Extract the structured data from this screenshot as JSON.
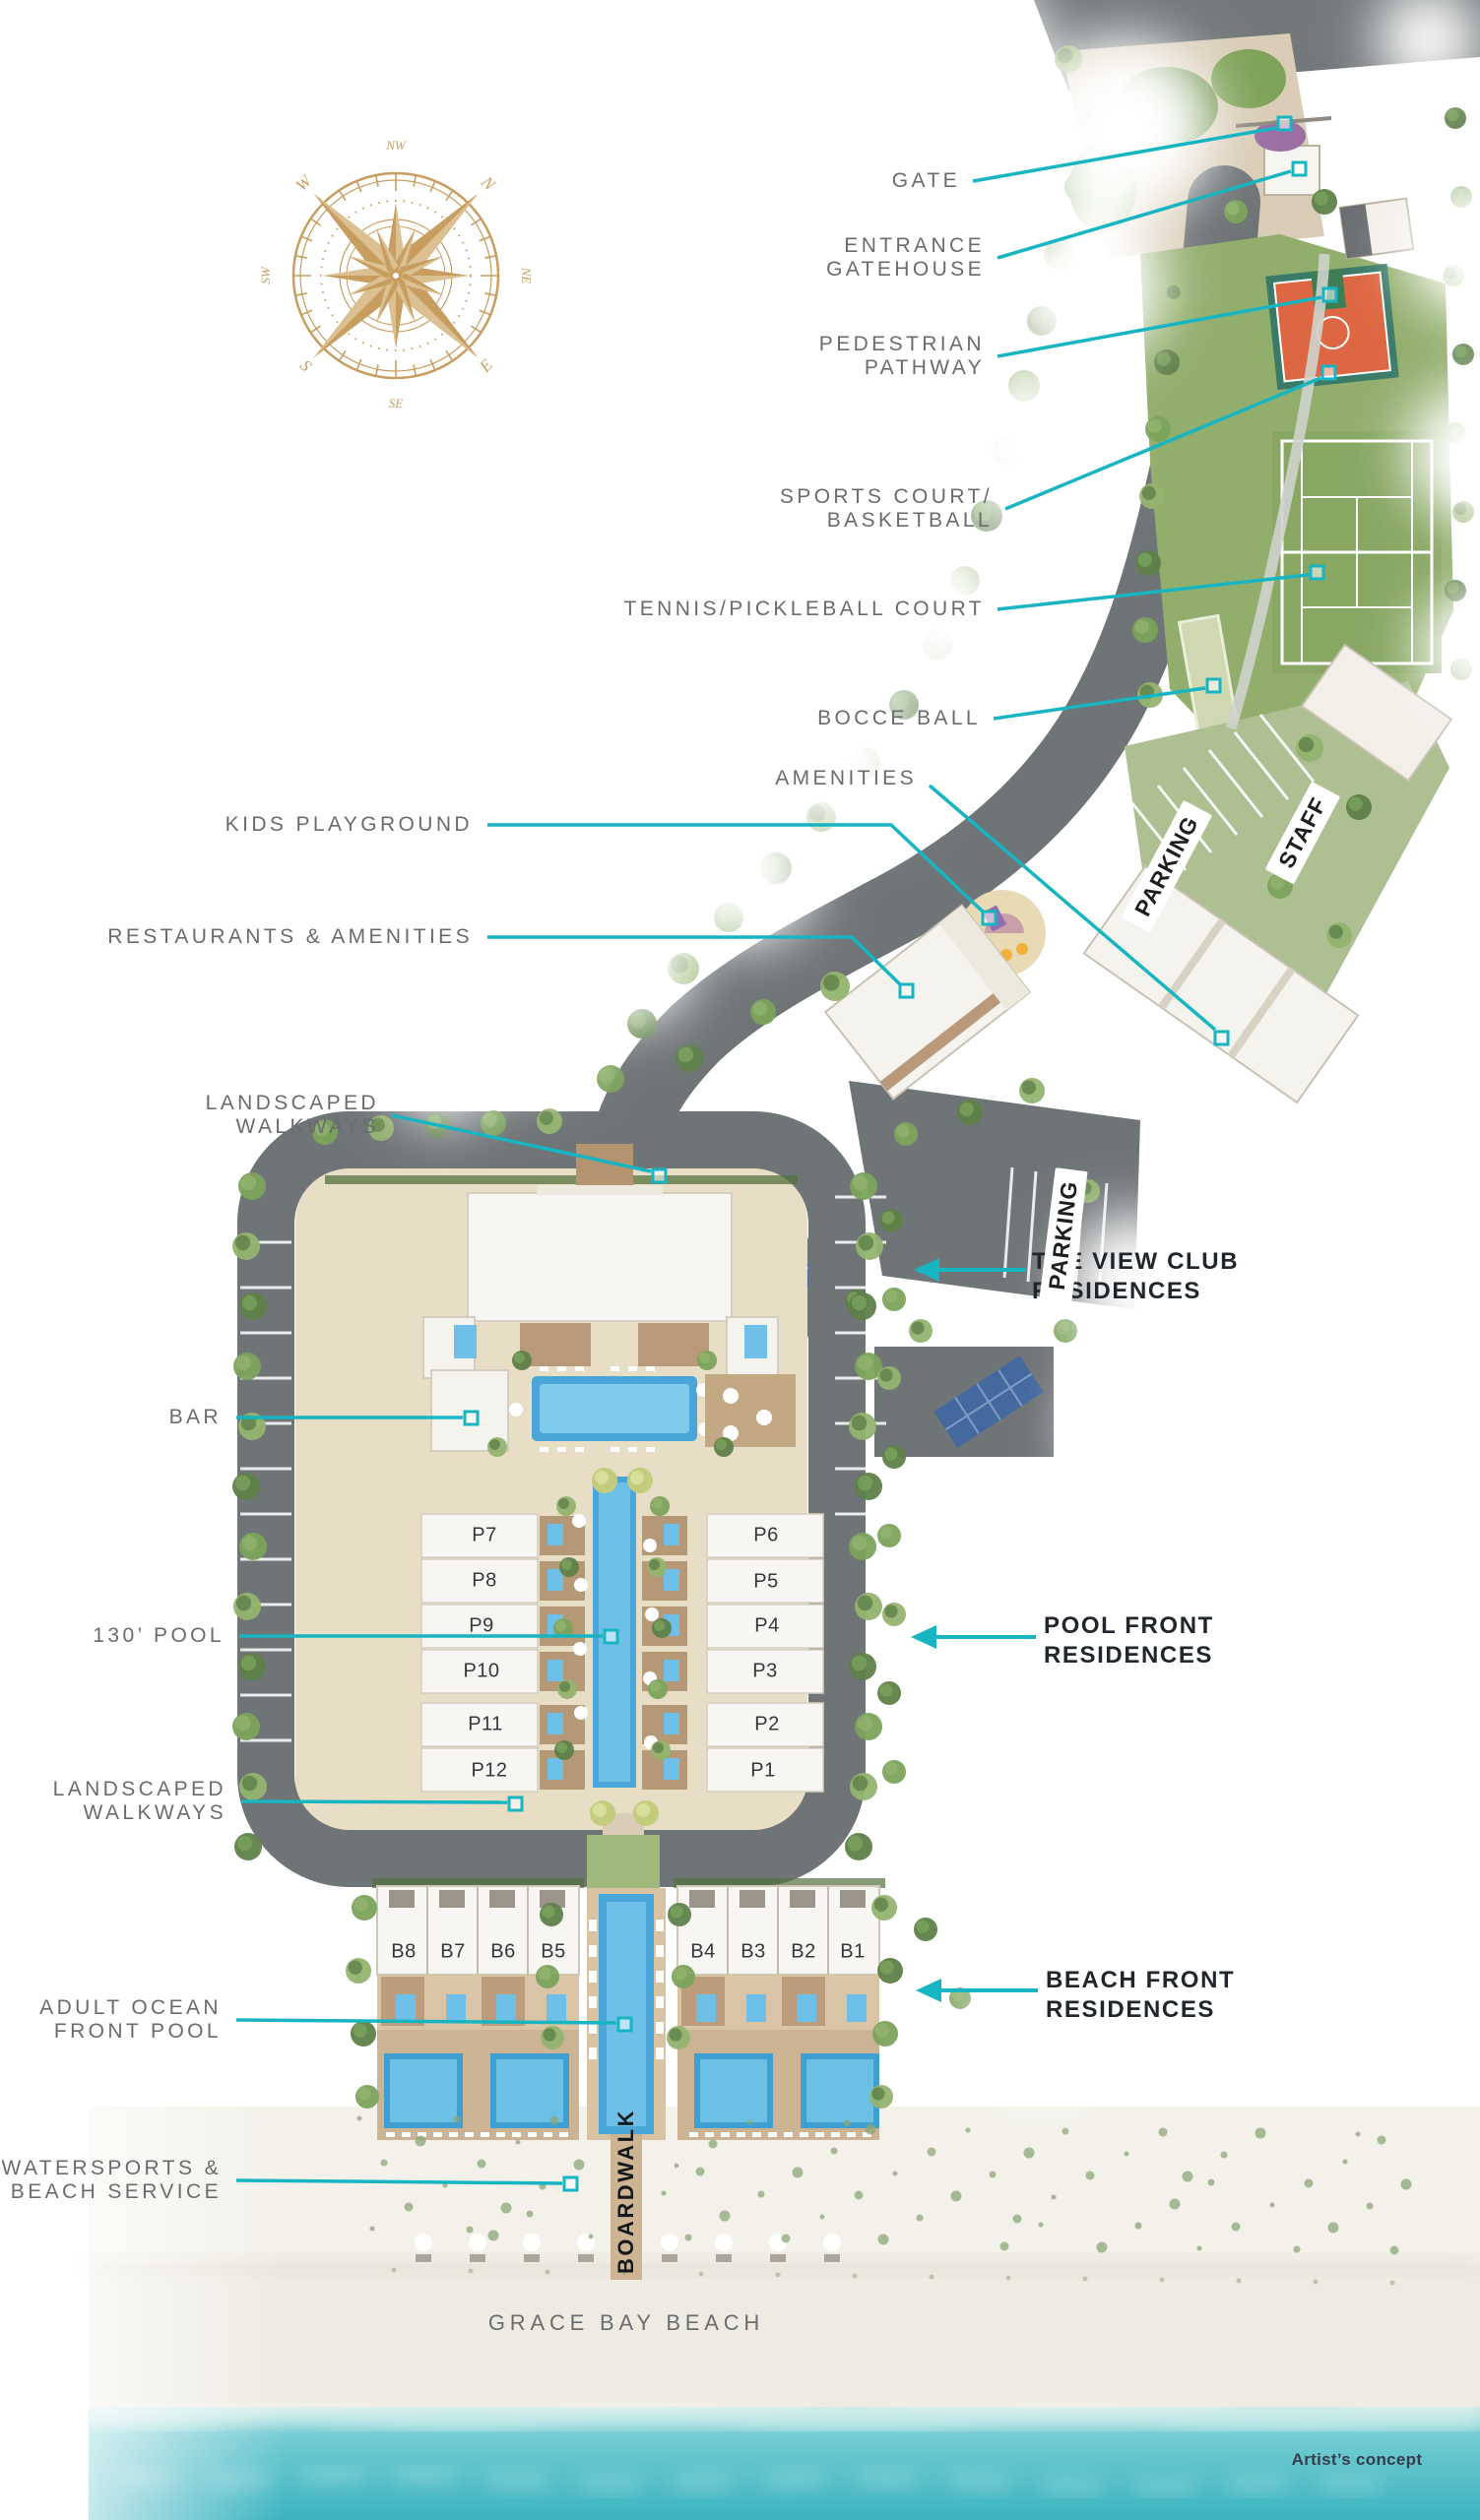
{
  "annotations": {
    "callouts": [
      {
        "id": "gate",
        "lines": [
          "GATE"
        ]
      },
      {
        "id": "entrance-gatehouse",
        "lines": [
          "ENTRANCE",
          "GATEHOUSE"
        ]
      },
      {
        "id": "pedestrian-pathway",
        "lines": [
          "PEDESTRIAN",
          "PATHWAY"
        ]
      },
      {
        "id": "sports-court-basketball",
        "lines": [
          "SPORTS COURT/",
          "BASKETBALL"
        ]
      },
      {
        "id": "tennis-pickleball-court",
        "lines": [
          "TENNIS/PICKLEBALL COURT"
        ]
      },
      {
        "id": "bocce-ball",
        "lines": [
          "BOCCE BALL"
        ]
      },
      {
        "id": "amenities",
        "lines": [
          "AMENITIES"
        ]
      },
      {
        "id": "kids-playground",
        "lines": [
          "KIDS PLAYGROUND"
        ]
      },
      {
        "id": "restaurants-amenities",
        "lines": [
          "RESTAURANTS & AMENITIES"
        ]
      },
      {
        "id": "landscaped-walkways-north",
        "lines": [
          "LANDSCAPED",
          "WALKWAYS"
        ]
      },
      {
        "id": "bar",
        "lines": [
          "BAR"
        ]
      },
      {
        "id": "pool-130",
        "lines": [
          "130’ POOL"
        ]
      },
      {
        "id": "landscaped-walkways-south",
        "lines": [
          "LANDSCAPED",
          "WALKWAYS"
        ]
      },
      {
        "id": "adult-ocean-front-pool",
        "lines": [
          "ADULT OCEAN",
          "FRONT POOL"
        ]
      },
      {
        "id": "watersports-beach-service",
        "lines": [
          "WATERSPORTS &",
          "BEACH SERVICE"
        ]
      }
    ],
    "residences": [
      {
        "id": "view-club-residences",
        "lines": [
          "THE VIEW CLUB",
          "RESIDENCES"
        ]
      },
      {
        "id": "pool-front-residences",
        "lines": [
          "POOL FRONT",
          "RESIDENCES"
        ]
      },
      {
        "id": "beach-front-residences",
        "lines": [
          "BEACH FRONT",
          "RESIDENCES"
        ]
      }
    ]
  },
  "map_labels": {
    "parking_upper": "PARKING",
    "staff": "STAFF",
    "parking_lower": "PARKING",
    "boardwalk": "BOARDWALK",
    "beach_name": "GRACE BAY BEACH"
  },
  "units": {
    "pool_front": [
      "P7",
      "P8",
      "P9",
      "P10",
      "P11",
      "P12",
      "P6",
      "P5",
      "P4",
      "P3",
      "P2",
      "P1"
    ],
    "beach_front": [
      "B8",
      "B7",
      "B6",
      "B5",
      "B4",
      "B3",
      "B2",
      "B1"
    ]
  },
  "compass": {
    "directions": [
      "NW",
      "N",
      "NE",
      "E",
      "SE",
      "S",
      "SW",
      "W"
    ]
  },
  "footer": {
    "artist_note": "Artist’s concept"
  },
  "colors": {
    "teal": "#17b4c2",
    "gold": "#c79d60",
    "label_gray": "#696c6f",
    "label_dark": "#20262b"
  }
}
